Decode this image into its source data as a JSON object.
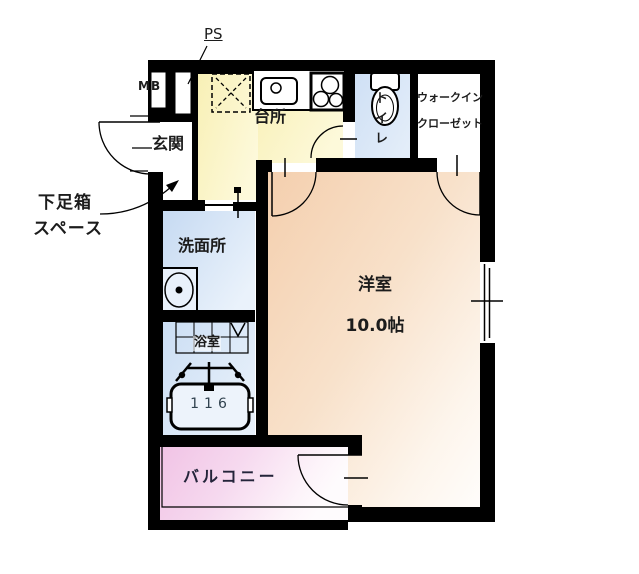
{
  "floor_plan": {
    "labels": {
      "ps": "PS",
      "mb": "MB",
      "genkan": "玄関",
      "kitchen": "台所",
      "toilet": "トイレ",
      "wic_line1": "ウォークイン",
      "wic_line2": "クローゼット",
      "shoebox_line1": "下足箱",
      "shoebox_line2": "スペース",
      "washroom": "洗面所",
      "bathroom": "浴室",
      "bathtub_size": "116",
      "main_room_name": "洋室",
      "main_room_size": "10.0帖",
      "balcony": "バルコニー"
    },
    "colors": {
      "wall": "#000000",
      "kitchen_floor": "#faf3c2",
      "washroom_floor": "#c9dcf3",
      "bathroom_floor": "#cddff4",
      "toilet_floor": "#d3e2f6",
      "closet_floor": "#ffffff",
      "main_room_floor": "#f4cfae",
      "balcony_floor": "#f1c4e6"
    }
  }
}
